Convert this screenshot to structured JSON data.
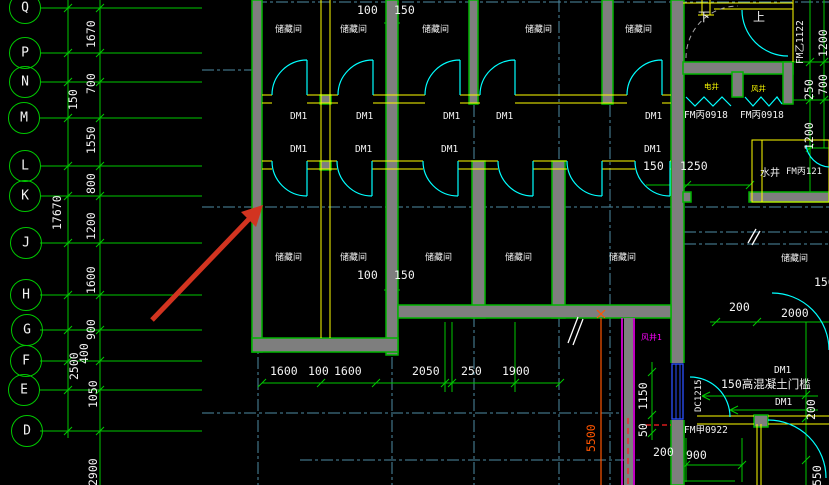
{
  "canvas": {
    "width": 829,
    "height": 485,
    "background": "#000000"
  },
  "palette": {
    "grid_green": "#00c800",
    "wall_stroke": "#00b400",
    "wall_fill": "#7e7e7e",
    "centerline_teal": "#4e8ca4",
    "door_cyan": "#00ffff",
    "frame_yellow": "#ffff00",
    "text_white": "#f2f2f2",
    "shaft_magenta": "#ff00ff",
    "dim_orange": "#ff5500",
    "annotation_red": "#d23420",
    "window_blue": "#2b50ff"
  },
  "axes": {
    "bubbles": [
      "Q",
      "P",
      "N",
      "M",
      "L",
      "K",
      "J",
      "H",
      "G",
      "F",
      "E",
      "D"
    ]
  },
  "dims": {
    "left": [
      "1670",
      "700",
      "150",
      "1550",
      "800",
      "17670",
      "1200",
      "1600",
      "900",
      "400",
      "2500",
      "1050",
      "2900"
    ],
    "top": [
      "100",
      "150"
    ],
    "mid": [
      "100",
      "150"
    ],
    "row_right": [
      "150",
      "1250"
    ],
    "bottom": [
      "1600",
      "100",
      "1600",
      "2050",
      "250",
      "1900"
    ],
    "right": [
      "1200",
      "250",
      "700",
      "1200",
      "150",
      "200",
      "2000",
      "200",
      "550"
    ],
    "lower_right": [
      "1150",
      "50",
      "200",
      "900"
    ],
    "shaft_height": "5500"
  },
  "rooms": {
    "storage": "储藏间",
    "water_shaft": "水井",
    "vent_shaft": "风井1",
    "elec_shaft": "电井",
    "air_shaft": "风井"
  },
  "tags": {
    "dm1": "DM1",
    "fm_b0918": "FM丙0918",
    "fm_y1122": "FM乙1122",
    "fm_b121": "FM丙121",
    "fm_j0922": "FM甲0922",
    "dc1215": "DC1215"
  },
  "stair": {
    "down": "下",
    "up": "上"
  },
  "notes": {
    "threshold": "150高混凝土门槛"
  }
}
